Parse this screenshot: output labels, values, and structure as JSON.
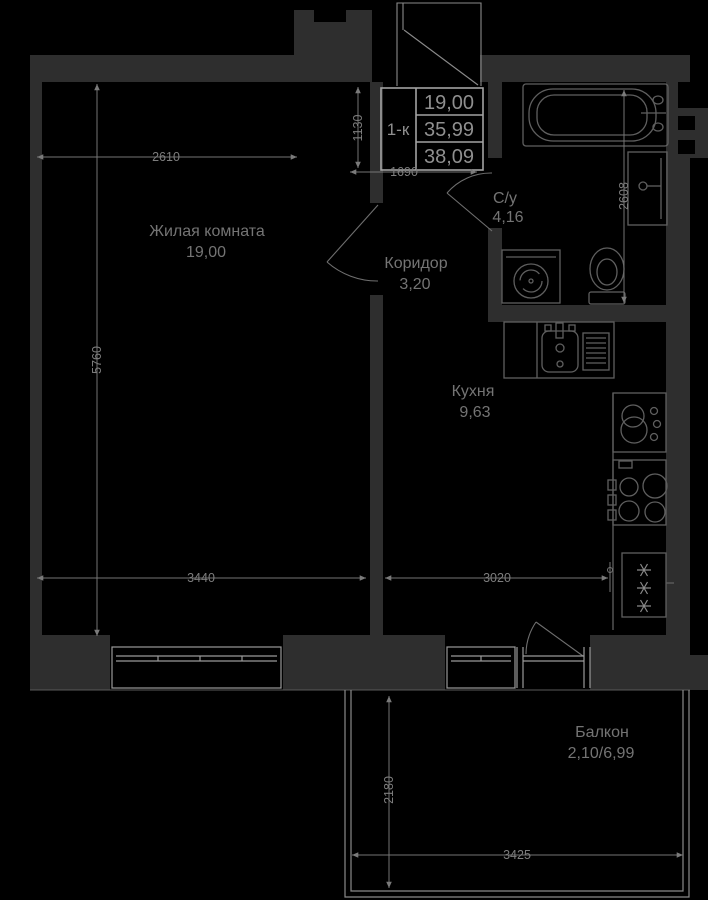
{
  "info_box": {
    "type": "1-к",
    "living_area": "19,00",
    "apartment_area": "35,99",
    "total_area": "38,09"
  },
  "rooms": {
    "living": {
      "name": "Жилая комната",
      "area": "19,00"
    },
    "corridor": {
      "name": "Коридор",
      "area": "3,20"
    },
    "bathroom": {
      "name": "С/у",
      "area": "4,16"
    },
    "kitchen": {
      "name": "Кухня",
      "area": "9,63"
    },
    "balcony": {
      "name": "Балкон",
      "area": "2,10/6,99"
    }
  },
  "dimensions": {
    "living_top_width": "2610",
    "hall_height": "1130",
    "hall_width": "1690",
    "living_left_height": "5760",
    "bathroom_height": "2608",
    "living_bottom_width": "3440",
    "kitchen_bottom_width": "3020",
    "balcony_depth": "2180",
    "balcony_width": "3425"
  },
  "colors": {
    "background": "#000000",
    "wall_fill": "#2e2e2e",
    "line": "#757575",
    "text": "#7d7d7d",
    "bright_line": "#a3a3a3"
  }
}
